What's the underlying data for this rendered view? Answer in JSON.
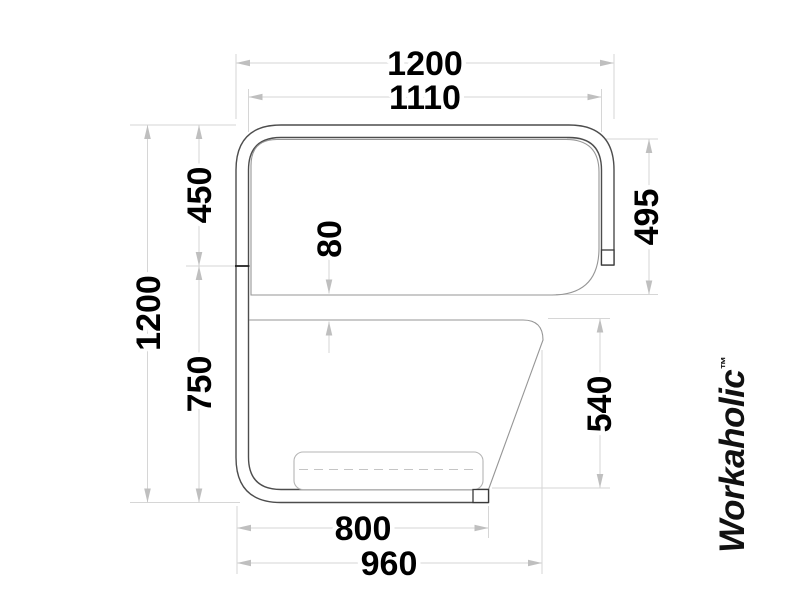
{
  "logo": {
    "text": "Workaholic",
    "tm": "™"
  },
  "dimensions": {
    "total_width": "1200",
    "inner_width": "1110",
    "total_height": "1200",
    "upper_section_height": "450",
    "lower_section_height": "750",
    "panel_height": "495",
    "panel_gap": "80",
    "lower_panel_height": "540",
    "seat_length": "800",
    "base_length": "960"
  },
  "colors": {
    "outline": "#4d4d4d",
    "secondary_line": "#969696",
    "cushion_line": "#b5b5b5",
    "dimension_line": "#d6d6d6",
    "arrow": "#bfbfbf",
    "text": "#000000",
    "logo": "#111111"
  }
}
